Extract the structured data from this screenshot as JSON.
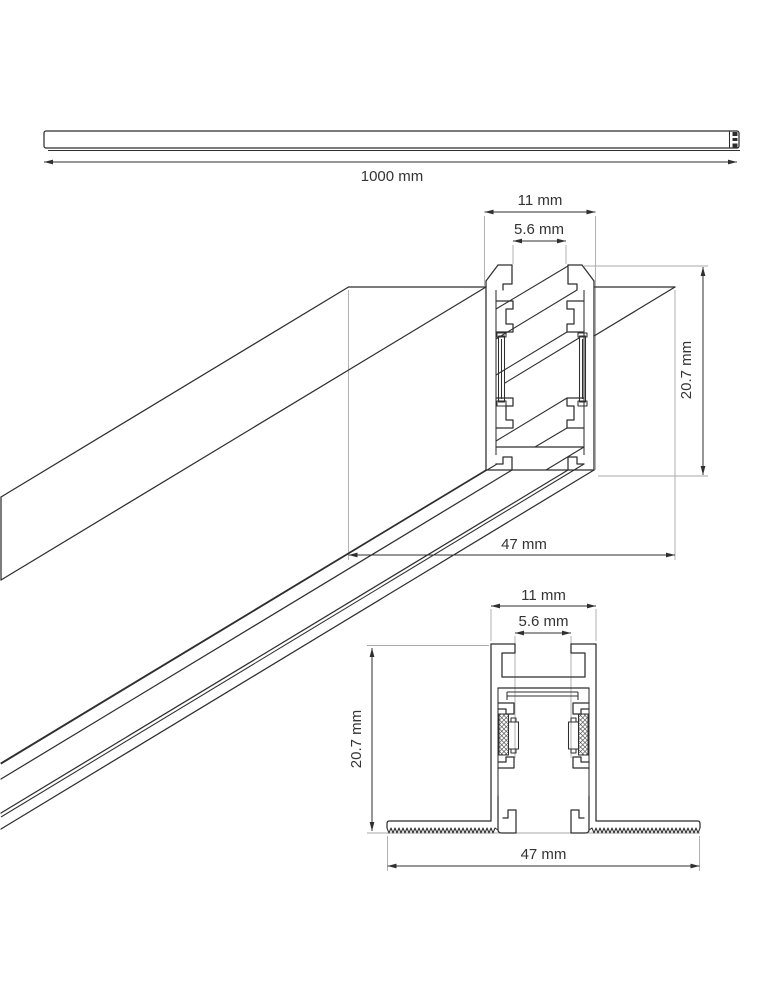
{
  "drawing": {
    "type": "technical-drawing",
    "subject": "magnetic track profile",
    "colors": {
      "line": "#2f2f2f",
      "extension": "#aaaaaa",
      "text": "#333333",
      "background": "#ffffff"
    },
    "views": {
      "side": {
        "name": "side view of full rail",
        "dims": {
          "length": "1000 mm"
        }
      },
      "iso": {
        "name": "3d view with cross-section",
        "dims": {
          "width": "11 mm",
          "slot": "5.6 mm",
          "height": "20.7 mm",
          "base": "47 mm"
        }
      },
      "section": {
        "name": "recessed cross-section",
        "dims": {
          "width": "11 mm",
          "slot": "5.6 mm",
          "height": "20.7 mm",
          "base": "47 mm"
        }
      }
    }
  }
}
